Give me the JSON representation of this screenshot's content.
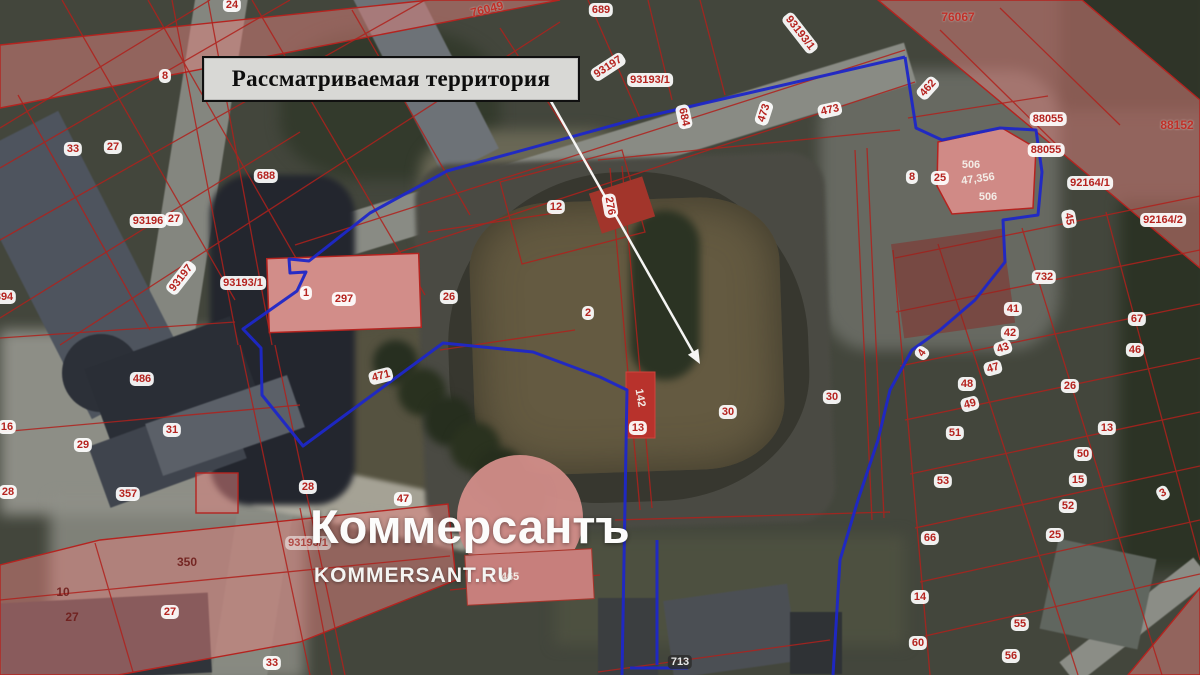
{
  "annotation": {
    "text": "Рассматриваемая территория"
  },
  "watermark": {
    "logo": "Коммерсантъ",
    "site": "KOMMERSANT.RU"
  },
  "map": {
    "boundary_color": "#1e27c8",
    "cadastral_color": "#b0211c",
    "labels": [
      {
        "t": "24",
        "x": 232,
        "y": 5,
        "s": "badge"
      },
      {
        "t": "76049",
        "x": 487,
        "y": 9,
        "s": "red",
        "r": -14
      },
      {
        "t": "689",
        "x": 601,
        "y": 10,
        "s": "badge"
      },
      {
        "t": "76067",
        "x": 958,
        "y": 17,
        "s": "red"
      },
      {
        "t": "93193/1",
        "x": 800,
        "y": 33,
        "s": "badge",
        "r": 52
      },
      {
        "t": "8",
        "x": 165,
        "y": 76,
        "s": "badge"
      },
      {
        "t": "93197",
        "x": 608,
        "y": 67,
        "s": "badge",
        "r": -33
      },
      {
        "t": "93193/1",
        "x": 650,
        "y": 80,
        "s": "badge"
      },
      {
        "t": "462",
        "x": 928,
        "y": 88,
        "s": "badge",
        "r": -48
      },
      {
        "t": "473",
        "x": 764,
        "y": 113,
        "s": "badge",
        "r": -72
      },
      {
        "t": "473",
        "x": 830,
        "y": 110,
        "s": "badge",
        "r": -12
      },
      {
        "t": "684",
        "x": 684,
        "y": 117,
        "s": "badge",
        "r": 78
      },
      {
        "t": "88055",
        "x": 1048,
        "y": 119,
        "s": "badge"
      },
      {
        "t": "88152",
        "x": 1177,
        "y": 125,
        "s": "red"
      },
      {
        "t": "33",
        "x": 73,
        "y": 149,
        "s": "badge"
      },
      {
        "t": "27",
        "x": 113,
        "y": 147,
        "s": "badge"
      },
      {
        "t": "88055",
        "x": 1046,
        "y": 150,
        "s": "badge"
      },
      {
        "t": "506",
        "x": 971,
        "y": 165,
        "s": "white"
      },
      {
        "t": "688",
        "x": 266,
        "y": 176,
        "s": "badge"
      },
      {
        "t": "8",
        "x": 912,
        "y": 177,
        "s": "badge"
      },
      {
        "t": "25",
        "x": 940,
        "y": 178,
        "s": "badge"
      },
      {
        "t": "47,356",
        "x": 978,
        "y": 179,
        "s": "white",
        "r": -8
      },
      {
        "t": "92164/1",
        "x": 1090,
        "y": 183,
        "s": "badge"
      },
      {
        "t": "506",
        "x": 988,
        "y": 197,
        "s": "white"
      },
      {
        "t": "12",
        "x": 556,
        "y": 207,
        "s": "badge"
      },
      {
        "t": "276",
        "x": 610,
        "y": 206,
        "s": "badge",
        "r": 80
      },
      {
        "t": "27",
        "x": 174,
        "y": 219,
        "s": "badge"
      },
      {
        "t": "93196",
        "x": 148,
        "y": 221,
        "s": "badge"
      },
      {
        "t": "45",
        "x": 1069,
        "y": 219,
        "s": "badge",
        "r": 80
      },
      {
        "t": "92164/2",
        "x": 1163,
        "y": 220,
        "s": "badge"
      },
      {
        "t": "93197",
        "x": 181,
        "y": 278,
        "s": "badge",
        "r": -52
      },
      {
        "t": "93193/1",
        "x": 243,
        "y": 283,
        "s": "badge"
      },
      {
        "t": "732",
        "x": 1044,
        "y": 277,
        "s": "badge"
      },
      {
        "t": "1",
        "x": 306,
        "y": 293,
        "s": "badge"
      },
      {
        "t": "394",
        "x": 4,
        "y": 297,
        "s": "badge"
      },
      {
        "t": "26",
        "x": 449,
        "y": 297,
        "s": "badge"
      },
      {
        "t": "297",
        "x": 344,
        "y": 299,
        "s": "badge"
      },
      {
        "t": "41",
        "x": 1013,
        "y": 309,
        "s": "badge"
      },
      {
        "t": "2",
        "x": 588,
        "y": 313,
        "s": "badge"
      },
      {
        "t": "67",
        "x": 1137,
        "y": 319,
        "s": "badge"
      },
      {
        "t": "42",
        "x": 1010,
        "y": 333,
        "s": "badge"
      },
      {
        "t": "43",
        "x": 1003,
        "y": 348,
        "s": "badge",
        "r": -18
      },
      {
        "t": "46",
        "x": 1135,
        "y": 350,
        "s": "badge"
      },
      {
        "t": "4",
        "x": 922,
        "y": 353,
        "s": "badge",
        "r": -55
      },
      {
        "t": "47",
        "x": 993,
        "y": 368,
        "s": "badge",
        "r": -15
      },
      {
        "t": "471",
        "x": 381,
        "y": 376,
        "s": "badge",
        "r": -14
      },
      {
        "t": "486",
        "x": 142,
        "y": 379,
        "s": "badge"
      },
      {
        "t": "48",
        "x": 967,
        "y": 384,
        "s": "badge"
      },
      {
        "t": "26",
        "x": 1070,
        "y": 386,
        "s": "badge"
      },
      {
        "t": "30",
        "x": 832,
        "y": 397,
        "s": "badge"
      },
      {
        "t": "142",
        "x": 640,
        "y": 398,
        "s": "white",
        "r": 80
      },
      {
        "t": "49",
        "x": 970,
        "y": 404,
        "s": "badge",
        "r": -15
      },
      {
        "t": "30",
        "x": 728,
        "y": 412,
        "s": "badge"
      },
      {
        "t": "16",
        "x": 7,
        "y": 427,
        "s": "badge"
      },
      {
        "t": "13",
        "x": 638,
        "y": 428,
        "s": "badge"
      },
      {
        "t": "13",
        "x": 1107,
        "y": 428,
        "s": "badge"
      },
      {
        "t": "31",
        "x": 172,
        "y": 430,
        "s": "badge"
      },
      {
        "t": "51",
        "x": 955,
        "y": 433,
        "s": "badge"
      },
      {
        "t": "29",
        "x": 83,
        "y": 445,
        "s": "badge"
      },
      {
        "t": "50",
        "x": 1083,
        "y": 454,
        "s": "badge"
      },
      {
        "t": "15",
        "x": 1078,
        "y": 480,
        "s": "badge"
      },
      {
        "t": "53",
        "x": 943,
        "y": 481,
        "s": "badge"
      },
      {
        "t": "28",
        "x": 308,
        "y": 487,
        "s": "badge"
      },
      {
        "t": "28",
        "x": 8,
        "y": 492,
        "s": "badge"
      },
      {
        "t": "3",
        "x": 1163,
        "y": 493,
        "s": "badge",
        "r": -28
      },
      {
        "t": "357",
        "x": 128,
        "y": 494,
        "s": "badge"
      },
      {
        "t": "47",
        "x": 403,
        "y": 499,
        "s": "badge"
      },
      {
        "t": "52",
        "x": 1068,
        "y": 506,
        "s": "badge"
      },
      {
        "t": "25",
        "x": 1055,
        "y": 535,
        "s": "badge"
      },
      {
        "t": "66",
        "x": 930,
        "y": 538,
        "s": "badge"
      },
      {
        "t": "93193/1",
        "x": 308,
        "y": 543,
        "s": "badge faint"
      },
      {
        "t": "350",
        "x": 187,
        "y": 562,
        "s": "onpink"
      },
      {
        "t": "465",
        "x": 510,
        "y": 577,
        "s": "white"
      },
      {
        "t": "10",
        "x": 63,
        "y": 592,
        "s": "onpink"
      },
      {
        "t": "14",
        "x": 920,
        "y": 597,
        "s": "badge"
      },
      {
        "t": "27",
        "x": 170,
        "y": 612,
        "s": "badge"
      },
      {
        "t": "27",
        "x": 72,
        "y": 617,
        "s": "onpink"
      },
      {
        "t": "55",
        "x": 1020,
        "y": 624,
        "s": "badge"
      },
      {
        "t": "60",
        "x": 918,
        "y": 643,
        "s": "badge"
      },
      {
        "t": "56",
        "x": 1011,
        "y": 656,
        "s": "badge"
      },
      {
        "t": "33",
        "x": 272,
        "y": 663,
        "s": "badge"
      },
      {
        "t": "713",
        "x": 680,
        "y": 662,
        "s": "dark"
      }
    ]
  }
}
